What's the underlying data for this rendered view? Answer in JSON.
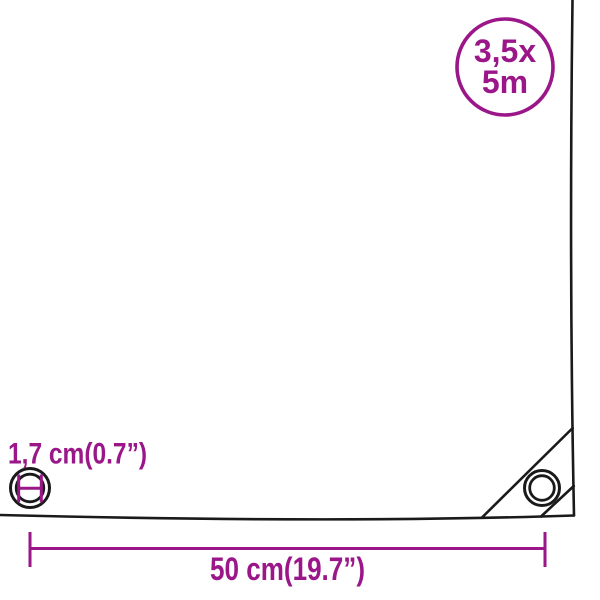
{
  "diagram": {
    "type": "product-dimension-infographic",
    "badge": {
      "line1": "3,5x",
      "line2": "5m"
    },
    "labels": {
      "eyelet_diameter": "1,7 cm(0.7”)",
      "edge_width": "50 cm(19.7”)"
    },
    "icons": [
      "size-badge-circle",
      "eyelet-detail-icon",
      "eyelet-diameter-mark-icon",
      "corner-grommet-icon",
      "width-dimension-line"
    ],
    "colors": {
      "accent": "#9A1689",
      "line": "#1a1a1a",
      "background": "#ffffff"
    }
  }
}
